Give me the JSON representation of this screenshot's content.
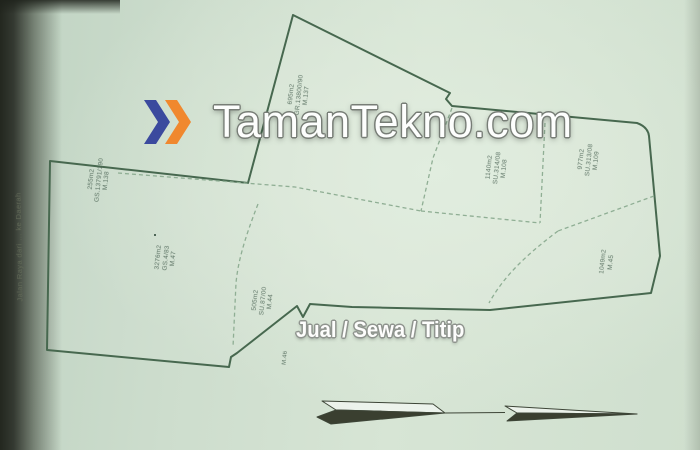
{
  "watermark": {
    "brand": "TamanTekno.com",
    "tagline": "Jual / Sewa / Titip",
    "chevron_blue": "#3b4a9e",
    "chevron_orange": "#f0882e"
  },
  "map": {
    "road_label": "Jalan Raya dari … ke Daerah",
    "plots": [
      {
        "id": "M.137",
        "doc": "GR.13800/90",
        "area": "695m2"
      },
      {
        "id": "M.138",
        "doc": "GS.13791/190",
        "area": "255m2"
      },
      {
        "id": "M.47",
        "doc": "GS.4/83",
        "area": "3276m2"
      },
      {
        "id": "M.44",
        "doc": "SU.87/00",
        "area": "505m2"
      },
      {
        "id": "M.46"
      },
      {
        "id": "M.108",
        "doc": "SU.314/08",
        "area": "1140m2"
      },
      {
        "id": "M.109",
        "doc": "SU.313/08",
        "area": "977m2"
      },
      {
        "id": "M.45",
        "area": "1049m2"
      }
    ],
    "colors": {
      "paper": "#d3e2d3",
      "boundary": "#47684f",
      "division": "#8fae94",
      "label_text": "#4d6556"
    }
  }
}
